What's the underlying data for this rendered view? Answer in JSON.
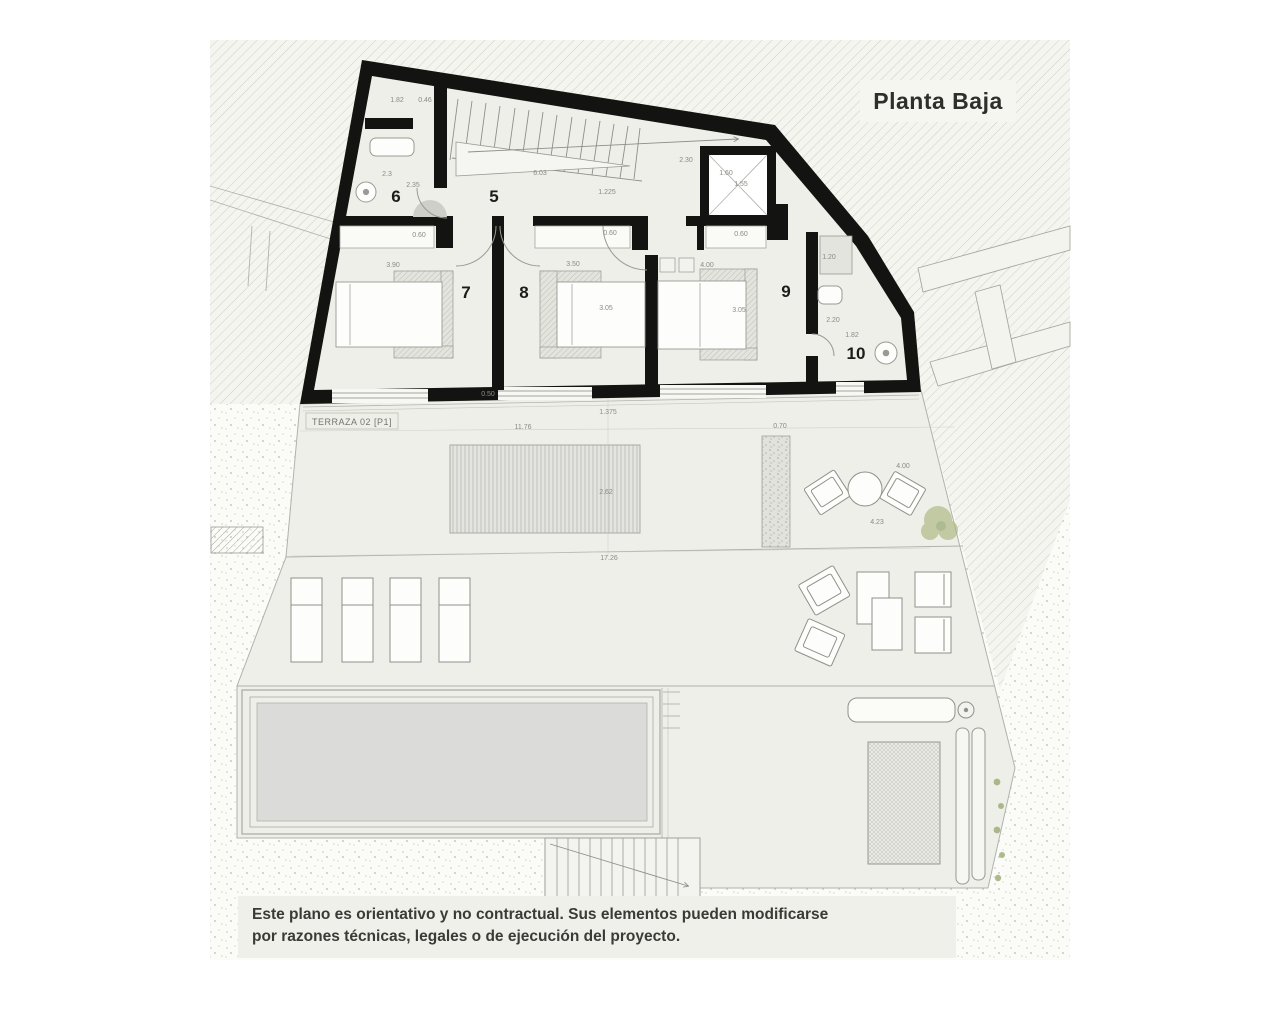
{
  "title": "Planta Baja",
  "disclaimer": {
    "line1": "Este plano es orientativo y no contractual. Sus elementos pueden modificarse",
    "line2": "por razones técnicas, legales o de ejecución del proyecto."
  },
  "plan": {
    "terrace_label": "TERRAZA 02 [P1]",
    "rooms": [
      {
        "n": "6",
        "x": 396,
        "y": 202
      },
      {
        "n": "5",
        "x": 494,
        "y": 202
      },
      {
        "n": "7",
        "x": 466,
        "y": 298
      },
      {
        "n": "8",
        "x": 524,
        "y": 298
      },
      {
        "n": "9",
        "x": 786,
        "y": 297
      },
      {
        "n": "10",
        "x": 856,
        "y": 359
      }
    ],
    "dimensions": [
      {
        "t": "1.82",
        "x": 397,
        "y": 102
      },
      {
        "t": "0.46",
        "x": 425,
        "y": 102
      },
      {
        "t": "2.3",
        "x": 387,
        "y": 176
      },
      {
        "t": "2.35",
        "x": 413,
        "y": 187
      },
      {
        "t": "6.03",
        "x": 540,
        "y": 175
      },
      {
        "t": "1.225",
        "x": 607,
        "y": 194
      },
      {
        "t": "2.30",
        "x": 686,
        "y": 162
      },
      {
        "t": "1.60",
        "x": 726,
        "y": 175
      },
      {
        "t": "1.55",
        "x": 741,
        "y": 186
      },
      {
        "t": "1.20",
        "x": 829,
        "y": 259
      },
      {
        "t": "0.60",
        "x": 419,
        "y": 237
      },
      {
        "t": "0.60",
        "x": 610,
        "y": 235
      },
      {
        "t": "0.60",
        "x": 741,
        "y": 236
      },
      {
        "t": "3.90",
        "x": 393,
        "y": 267
      },
      {
        "t": "3.50",
        "x": 573,
        "y": 266
      },
      {
        "t": "4.00",
        "x": 707,
        "y": 267
      },
      {
        "t": "3.05",
        "x": 606,
        "y": 310
      },
      {
        "t": "3.05",
        "x": 739,
        "y": 312
      },
      {
        "t": "2.20",
        "x": 833,
        "y": 322
      },
      {
        "t": "1.82",
        "x": 852,
        "y": 337
      },
      {
        "t": "0.50",
        "x": 488,
        "y": 396
      },
      {
        "t": "1.375",
        "x": 608,
        "y": 414
      },
      {
        "t": "11.76",
        "x": 523,
        "y": 429
      },
      {
        "t": "0.70",
        "x": 780,
        "y": 428
      },
      {
        "t": "4.00",
        "x": 903,
        "y": 468
      },
      {
        "t": "2.62",
        "x": 606,
        "y": 494
      },
      {
        "t": "4.23",
        "x": 877,
        "y": 524
      },
      {
        "t": "17.26",
        "x": 609,
        "y": 560
      }
    ]
  },
  "colors": {
    "wall": "#131311",
    "floor": "#edefe8",
    "paper": "#fcfcf8",
    "pool_water": "#dbdcda",
    "line": "#9a9a94",
    "plant_green": "#a8b77e",
    "title_text": "#2e2e2a",
    "dim_text": "#8c8c85"
  }
}
